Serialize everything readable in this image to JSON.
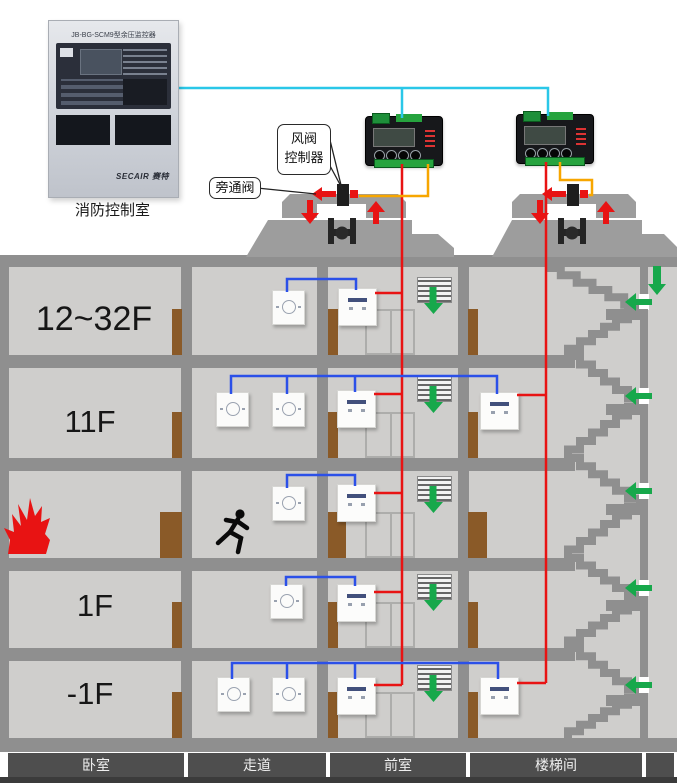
{
  "control_room": {
    "label": "消防控制室",
    "panel_title": "JB-BG-SCM9型余压监控器",
    "brand": "SECAIR 赛特"
  },
  "callouts": {
    "damper_controller_l1": "风阀",
    "damper_controller_l2": "控制器",
    "bypass_valve": "旁通阀"
  },
  "floor_labels": {
    "f12_32": "12~32F",
    "f11": "11F",
    "f1": "1F",
    "fb1": "-1F"
  },
  "zone_labels": [
    "卧室",
    "走道",
    "前室",
    "楼梯间"
  ],
  "colors": {
    "signal_bus_cyan": "#2ac7e8",
    "riser_red": "#e81313",
    "sensor_loop_blue": "#2b50e8",
    "control_wire_orange": "#f7a600",
    "airflow_green": "#17a84b",
    "door_brown": "#8a5a28",
    "wall_gray": "#8f8f8f",
    "room_gray": "#cfcecc",
    "controller_black": "#17181b"
  },
  "icons": {
    "flame-icon": "fire in bedroom",
    "runner-icon": "evacuating person",
    "grille-icon": "supply air vent grille",
    "airflow-down-arrow-icon": "green down airflow",
    "airflow-left-arrow-icon": "green airflow into stairwell",
    "bypass-arrow-icon": "red bypass air direction",
    "fan-icon": "rooftop pressurization fan",
    "valve-icon": "bypass damper actuator"
  }
}
